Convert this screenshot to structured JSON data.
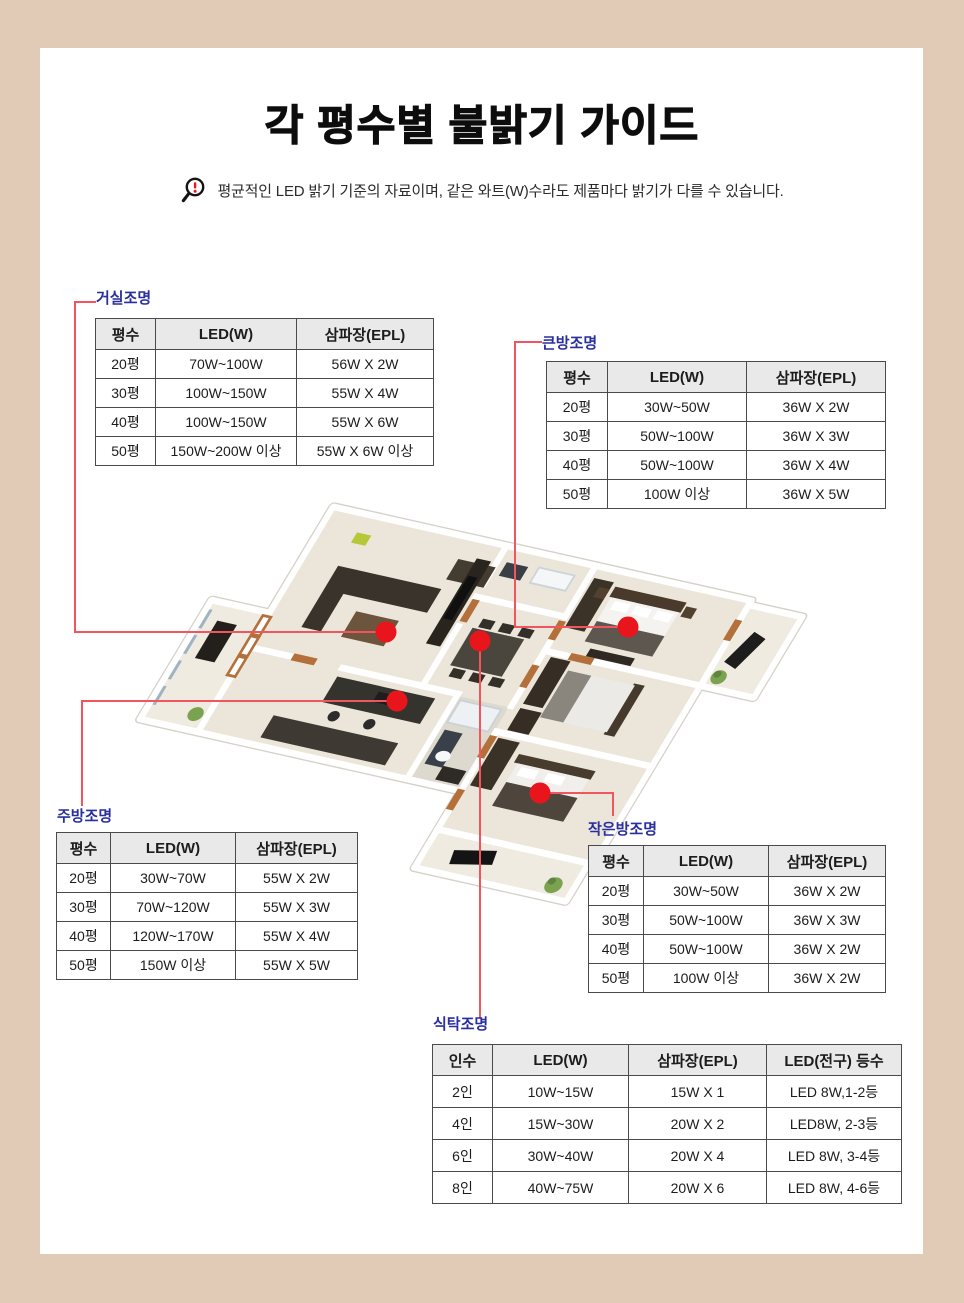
{
  "header": {
    "title": "각 평수별 불밝기 가이드",
    "notice": "평균적인 LED 밝기 기준의 자료이며, 같은 와트(W)수라도 제품마다 밝기가 다를 수 있습니다."
  },
  "colors": {
    "frame_tan": "#e1cbb7",
    "label_blue": "#2a2f9e",
    "leader_line_red": "#f2555e",
    "marker_dot_red": "#e8151d",
    "table_header_gray": "#e9e9e9",
    "table_border": "#4a4a4a"
  },
  "tables": {
    "living": {
      "label": "거실조명",
      "headers": [
        "평수",
        "LED(W)",
        "삼파장(EPL)"
      ],
      "rows": [
        [
          "20평",
          "70W~100W",
          "56W X 2W"
        ],
        [
          "30평",
          "100W~150W",
          "55W X 4W"
        ],
        [
          "40평",
          "100W~150W",
          "55W X 6W"
        ],
        [
          "50평",
          "150W~200W 이상",
          "55W X 6W 이상"
        ]
      ]
    },
    "big_room": {
      "label": "큰방조명",
      "headers": [
        "평수",
        "LED(W)",
        "삼파장(EPL)"
      ],
      "rows": [
        [
          "20평",
          "30W~50W",
          "36W X 2W"
        ],
        [
          "30평",
          "50W~100W",
          "36W X 3W"
        ],
        [
          "40평",
          "50W~100W",
          "36W X 4W"
        ],
        [
          "50평",
          "100W 이상",
          "36W X 5W"
        ]
      ]
    },
    "kitchen": {
      "label": "주방조명",
      "headers": [
        "평수",
        "LED(W)",
        "삼파장(EPL)"
      ],
      "rows": [
        [
          "20평",
          "30W~70W",
          "55W X 2W"
        ],
        [
          "30평",
          "70W~120W",
          "55W X 3W"
        ],
        [
          "40평",
          "120W~170W",
          "55W X 4W"
        ],
        [
          "50평",
          "150W 이상",
          "55W X 5W"
        ]
      ]
    },
    "small_room": {
      "label": "작은방조명",
      "headers": [
        "평수",
        "LED(W)",
        "삼파장(EPL)"
      ],
      "rows": [
        [
          "20평",
          "30W~50W",
          "36W X 2W"
        ],
        [
          "30평",
          "50W~100W",
          "36W X 3W"
        ],
        [
          "40평",
          "50W~100W",
          "36W X 2W"
        ],
        [
          "50평",
          "100W 이상",
          "36W X 2W"
        ]
      ]
    },
    "dining": {
      "label": "식탁조명",
      "headers": [
        "인수",
        "LED(W)",
        "삼파장(EPL)",
        "LED(전구) 등수"
      ],
      "rows": [
        [
          "2인",
          "10W~15W",
          "15W X 1",
          "LED 8W,1-2등"
        ],
        [
          "4인",
          "15W~30W",
          "20W X 2",
          "LED8W, 2-3등"
        ],
        [
          "6인",
          "30W~40W",
          "20W X 4",
          "LED 8W, 3-4등"
        ],
        [
          "8인",
          "40W~75W",
          "20W X 6",
          "LED 8W, 4-6등"
        ]
      ]
    }
  }
}
